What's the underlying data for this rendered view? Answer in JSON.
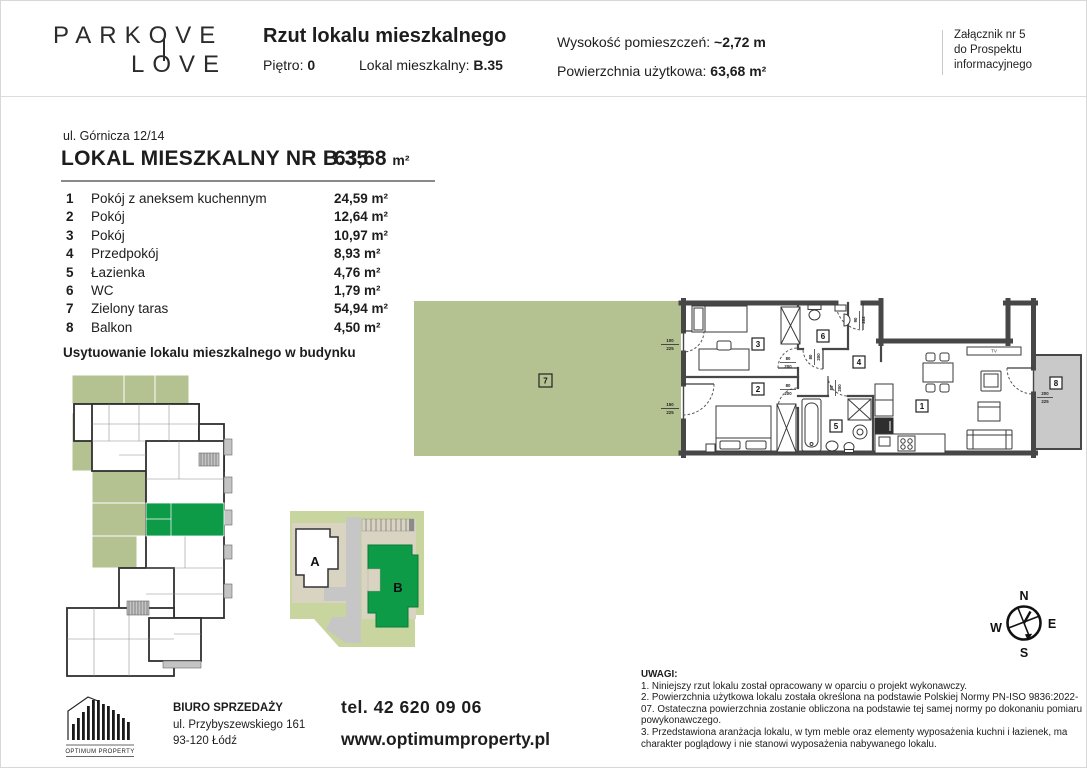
{
  "header": {
    "logo_line1": "PARKOVE",
    "logo_line2": "LOVE",
    "title": "Rzut lokalu mieszkalnego",
    "floor_label": "Piętro: ",
    "floor_value": "0",
    "unit_label": "Lokal mieszkalny: ",
    "unit_value": "B.35",
    "height_label": "Wysokość pomieszczeń: ",
    "height_value": "~2,72 m",
    "area_label": "Powierzchnia użytkowa: ",
    "area_value": "63,68 m²",
    "attachment_line1": "Załącznik nr 5",
    "attachment_line2": "do Prospektu",
    "attachment_line3": "informacyjnego"
  },
  "unit": {
    "address": "ul. Górnicza 12/14",
    "name": "LOKAL MIESZKALNY NR B.35",
    "area_value": "63,68",
    "area_unit": "m²",
    "rooms": [
      {
        "no": "1",
        "name": "Pokój z aneksem kuchennym",
        "area": "24,59 m²"
      },
      {
        "no": "2",
        "name": "Pokój",
        "area": "12,64 m²"
      },
      {
        "no": "3",
        "name": "Pokój",
        "area": "10,97 m²"
      },
      {
        "no": "4",
        "name": "Przedpokój",
        "area": "8,93 m²"
      },
      {
        "no": "5",
        "name": "Łazienka",
        "area": "4,76 m²"
      },
      {
        "no": "6",
        "name": "WC",
        "area": "1,79 m²"
      },
      {
        "no": "7",
        "name": "Zielony taras",
        "area": "54,94 m²"
      },
      {
        "no": "8",
        "name": "Balkon",
        "area": "4,50 m²"
      }
    ]
  },
  "location": {
    "title": "Usytuowanie lokalu mieszkalnego w budynku",
    "building_a": "A",
    "building_b": "B"
  },
  "plan": {
    "labels": [
      "1",
      "2",
      "3",
      "4",
      "5",
      "6",
      "7",
      "8"
    ],
    "tv": "TV",
    "dims": {
      "terrace_door_1": {
        "w": "100",
        "h": "225"
      },
      "terrace_door_2": {
        "w": "150",
        "h": "225"
      },
      "entrance": {
        "w": "90",
        "h": "202"
      },
      "room3_door": {
        "w": "80",
        "h": "200"
      },
      "room2_door": {
        "w": "80",
        "h": "200"
      },
      "wc_door": {
        "w": "80",
        "h": "200"
      },
      "bath_door": {
        "w": "80",
        "h": "200"
      },
      "balcony_door": {
        "w": "200",
        "h": "225"
      }
    }
  },
  "compass": {
    "n": "N",
    "e": "E",
    "s": "S",
    "w": "W"
  },
  "notes": {
    "heading": "UWAGI:",
    "items": [
      "1. Niniejszy rzut lokalu został opracowany w oparciu o projekt wykonawczy.",
      "2. Powierzchnia użytkowa lokalu została określona na podstawie Polskiej Normy PN-ISO 9836:2022-07. Ostateczna powierzchnia zostanie obliczona na podstawie tej samej normy po dokonaniu pomiaru powykonawczego.",
      "3. Przedstawiona aranżacja lokalu, w tym meble oraz elementy wyposażenia kuchni i łazienek, ma charakter poglądowy i nie stanowi wyposażenia nabywanego lokalu."
    ]
  },
  "footer": {
    "logo_text": "OPTIMUM PROPERTY",
    "office_label": "BIURO SPRZEDAŻY",
    "address_line1": "ul. Przybyszewskiego 161",
    "address_line2": "93-120 Łódź",
    "phone": "tel.  42 620 09 06",
    "website": "www.optimumproperty.pl"
  },
  "colors": {
    "accent_green": "#0d9b48",
    "terrace_green": "#b4c291",
    "site_green": "#c9d59e",
    "beige": "#d9d3c1",
    "road_gray": "#c6c6c6",
    "balcony_gray": "#c9c9c9",
    "wall_dark": "#474747"
  }
}
